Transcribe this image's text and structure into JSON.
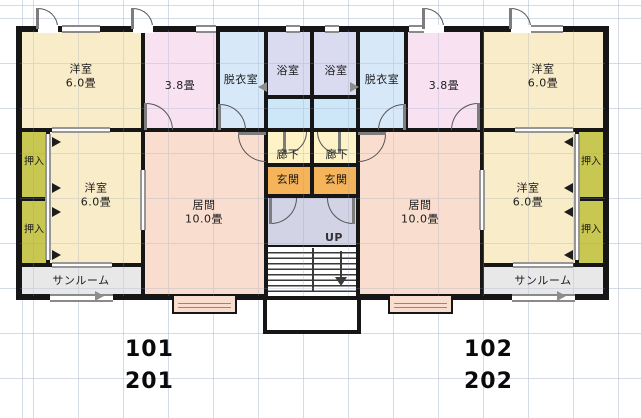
{
  "colors": {
    "wall": "#161616",
    "western_room": "#f9ecc8",
    "room_3_8": "#f8e2f2",
    "dressing": "#d7e8f8",
    "bath": "#dadaf0",
    "wc": "#cde7f8",
    "hallway": "#fdf3c6",
    "entrance": "#f5b459",
    "closet": "#c8c751",
    "sunroom": "#e8e8e8",
    "living": "#f9decf",
    "stair_hall": "#d2d3e5"
  },
  "rooms": {
    "yoshitsu_tl": {
      "name": "洋室",
      "size": "6.0畳"
    },
    "yoshitsu_bl": {
      "name": "洋室",
      "size": "6.0畳"
    },
    "yoshitsu_tr": {
      "name": "洋室",
      "size": "6.0畳"
    },
    "yoshitsu_br": {
      "name": "洋室",
      "size": "6.0畳"
    },
    "r38_l": {
      "name": "3.8畳"
    },
    "r38_r": {
      "name": "3.8畳"
    },
    "datsui_l": {
      "name": "脱衣室"
    },
    "datsui_r": {
      "name": "脱衣室"
    },
    "bath_l": {
      "name": "浴室"
    },
    "bath_r": {
      "name": "浴室"
    },
    "rouka_l": {
      "name": "廊下"
    },
    "rouka_r": {
      "name": "廊下"
    },
    "genkan_l": {
      "name": "玄関"
    },
    "genkan_r": {
      "name": "玄関"
    },
    "ima_l": {
      "name": "居間",
      "size": "10.0畳"
    },
    "ima_r": {
      "name": "居間",
      "size": "10.0畳"
    },
    "oshiire_l1": {
      "name": "押入"
    },
    "oshiire_l2": {
      "name": "押入"
    },
    "oshiire_r1": {
      "name": "押入"
    },
    "oshiire_r2": {
      "name": "押入"
    },
    "sunroom_l": {
      "name": "サンルーム"
    },
    "sunroom_r": {
      "name": "サンルーム"
    }
  },
  "stairs": {
    "direction_label": "UP"
  },
  "units": {
    "left_first": "101",
    "left_second": "201",
    "right_first": "102",
    "right_second": "202"
  }
}
